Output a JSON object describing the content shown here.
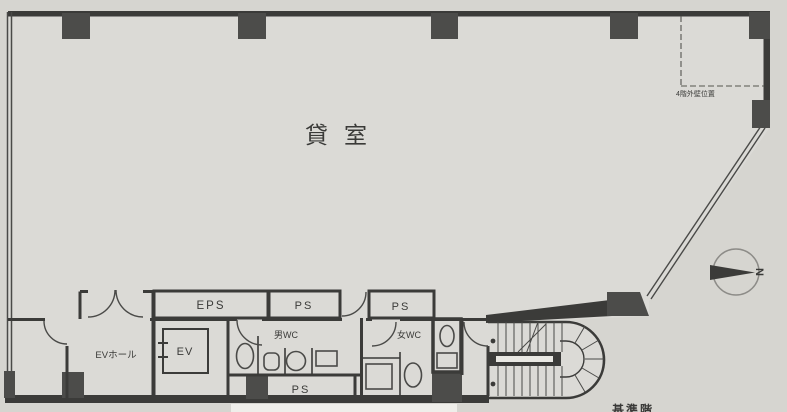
{
  "plan": {
    "main_room_label": "貸室",
    "eps_label": "EPS",
    "ps_top_left_label": "PS",
    "ps_top_right_label": "PS",
    "ps_bottom_label": "PS",
    "wc_men_label": "男WC",
    "wc_women_label": "女WC",
    "ev_label": "EV",
    "ev_hall_label": "EVホール",
    "annotation_4f_wall": "4階外壁位置",
    "caption": "基準階",
    "compass_north": "N",
    "colors": {
      "paper": "#d6d5d0",
      "floor": "#dbdad6",
      "wall": "#3b3b39",
      "column": "#4c4c4a",
      "ink": "#3a3a38"
    }
  }
}
